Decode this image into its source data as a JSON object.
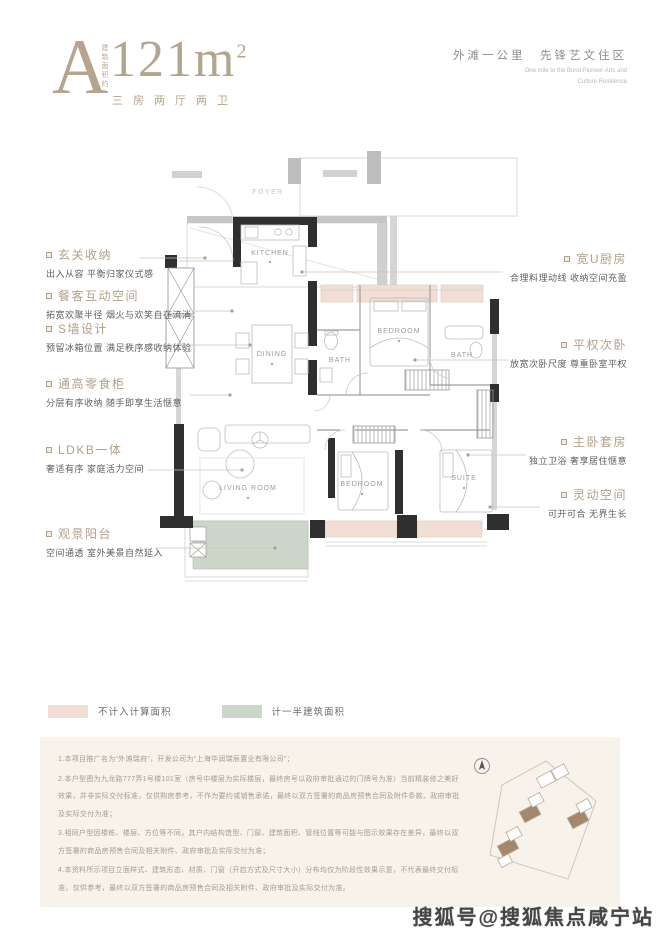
{
  "header": {
    "letter": "A",
    "area_vertical": "建筑面积约",
    "area_value": "121m",
    "area_sup": "2",
    "layout": "三房两厅两卫",
    "tagline_cn": "外滩一公里　先锋艺文住区",
    "tagline_en1": "One mile to the Bund Pioneer Arts and",
    "tagline_en2": "Culture Residence"
  },
  "plan": {
    "rooms": {
      "foyer": "FOYER",
      "kitchen": "KITCHEN",
      "dining": "DINING",
      "bath_a": "BATH",
      "bedroom_a": "BEDROOM",
      "bath_b": "BATH",
      "living": "LIVING ROOM",
      "bedroom_b": "BEDROOM",
      "suite": "SUITE"
    }
  },
  "annotations_left": [
    {
      "title": "玄关收纳",
      "desc": "出入从容 平衡归家仪式感"
    },
    {
      "title": "餐客互动空间",
      "desc": "拓宽欢聚半径 烟火与欢笑自在流淌"
    },
    {
      "title": "S墙设计",
      "desc": "预留冰箱位置 满足秩序感收纳体验"
    },
    {
      "title": "通高零食柜",
      "desc": "分层有序收纳 随手即享生活惬意"
    },
    {
      "title": "LDKB一体",
      "desc": "奢适有序 家庭活力空间"
    },
    {
      "title": "观景阳台",
      "desc": "空间通透 室外美景自然延入"
    }
  ],
  "annotations_right": [
    {
      "title": "宽U厨房",
      "desc": "合理料理动线 收纳空间充盈"
    },
    {
      "title": "平权次卧",
      "desc": "放宽次卧尺度 尊重卧室平权"
    },
    {
      "title": "主卧套房",
      "desc": "独立卫浴 奢享居住惬意"
    },
    {
      "title": "灵动空间",
      "desc": "可开可合 无界生长"
    }
  ],
  "legend": [
    {
      "label": "不计入计算面积",
      "color": "#f2ded4"
    },
    {
      "label": "计一半建筑面积",
      "color": "#ccd6ca"
    }
  ],
  "disclaimer": {
    "items": [
      "1.本项目推广名为“外滩瑞府”，开发公司为“上海华润瑞辰置业有限公司”；",
      "2.本户型图为九龙路777弄1号楼101室（房号中楼层为实际楼层，最终房号以政府审批通过的门牌号为准）当前精装修之美好效果，并非实际交付标准，仅供购房参考，不作为要约或销售承诺，最终以双方签署的商品房预售合同及附件条款、政府审批及实际交付为准；",
      "3.相同户型因楼栋、楼层、方位等不同，其户内结构造型、门窗、建筑面积、管线位置等可能与图示效果存在差异，最终以双方签署的商品房预售合同及相关附件、政府审批及实际交付为准；",
      "4.本资料所示项目立面样式、建筑形态、材质、门窗（开启方式及尺寸大小）分布均仅为阶段性效果示意，不代表最终交付标准，仅供参考，最终以双方签署的商品房预售合同及相关附件、政府审批及实际交付为准。"
    ]
  },
  "watermark": {
    "text": "搜狐号@搜狐焦点咸宁站"
  },
  "colors": {
    "accent_taupe": "#b3a08a",
    "bay_pink": "#f2ded4",
    "balcony_green": "#ccd6ca",
    "wall_black": "#2f2f2f",
    "disclaimer_bg": "#f7f2ea"
  }
}
